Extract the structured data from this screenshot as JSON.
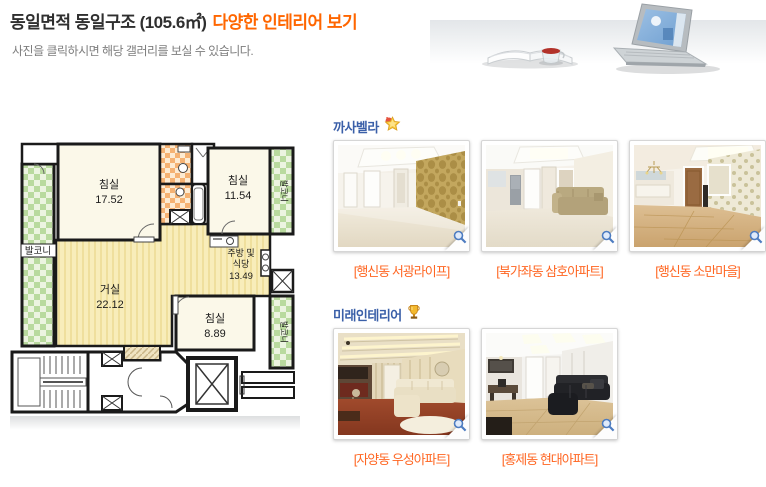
{
  "header": {
    "title_main": "동일면적 동일구조 (105.6㎡)",
    "title_accent": "다양한 인테리어 보기",
    "subtitle": "사진을 클릭하시면 해당 갤러리를 보실 수 있습니다."
  },
  "floorplan": {
    "rooms": {
      "bedroom1": {
        "name": "침실",
        "area": "17.52"
      },
      "bedroom2": {
        "name": "침실",
        "area": "11.54"
      },
      "bedroom3": {
        "name": "침실",
        "area": "8.89"
      },
      "living": {
        "name": "거실",
        "area": "22.12"
      },
      "kitchen_line1": "주방 및",
      "kitchen_line2": "식당",
      "kitchen_area": "13.49",
      "balcony": "발코니",
      "balcony_right_top": "발코니",
      "balcony_right_bottom": "발코니"
    }
  },
  "sections": [
    {
      "name": "까사벨라",
      "icon": "star-medal-icon",
      "photos": [
        {
          "caption": "[행신동 서광라이프]"
        },
        {
          "caption": "[북가좌동 삼호아파트]"
        },
        {
          "caption": "[행신동 소만마을]"
        }
      ]
    },
    {
      "name": "미래인테리어",
      "icon": "trophy-icon",
      "photos": [
        {
          "caption": "[자양동 우성아파트]"
        },
        {
          "caption": "[홍제동 현대아파트]"
        }
      ]
    }
  ],
  "colors": {
    "accent_orange": "#ff6600",
    "caption_orange": "#ff6622",
    "section_blue": "#3a5fa8"
  }
}
